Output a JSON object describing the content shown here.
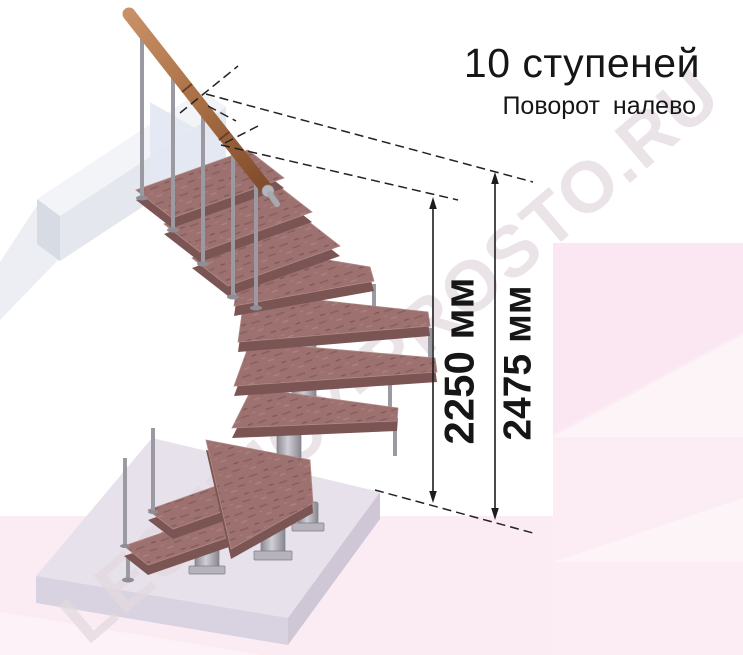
{
  "title": {
    "main": "10 ступеней",
    "subtitle": "Поворот налево"
  },
  "watermark_text": "LESTNICY-PROSTO.RU",
  "dimensions": {
    "staircase_height": {
      "label": "2250 мм",
      "value_mm": 2250
    },
    "total_height": {
      "label": "2475 мм",
      "value_mm": 2475
    }
  },
  "staircase": {
    "steps_total": 10,
    "turn_direction": "налево",
    "top_straight_steps": 3,
    "winder_steps": 5,
    "bottom_straight_steps": 2,
    "has_handrail": true
  },
  "colors": {
    "wood_tread": "#9d7170",
    "wood_edge": "#7b5553",
    "handrail": "#a96f44",
    "metal": "#9b9aa3",
    "floor_slab": "#e7e1ec",
    "landing_slab": "#eef0f6",
    "background_pink": "#fbecf4",
    "dimension_ink": "#1d1d1d",
    "watermark": "#e3d9df"
  }
}
